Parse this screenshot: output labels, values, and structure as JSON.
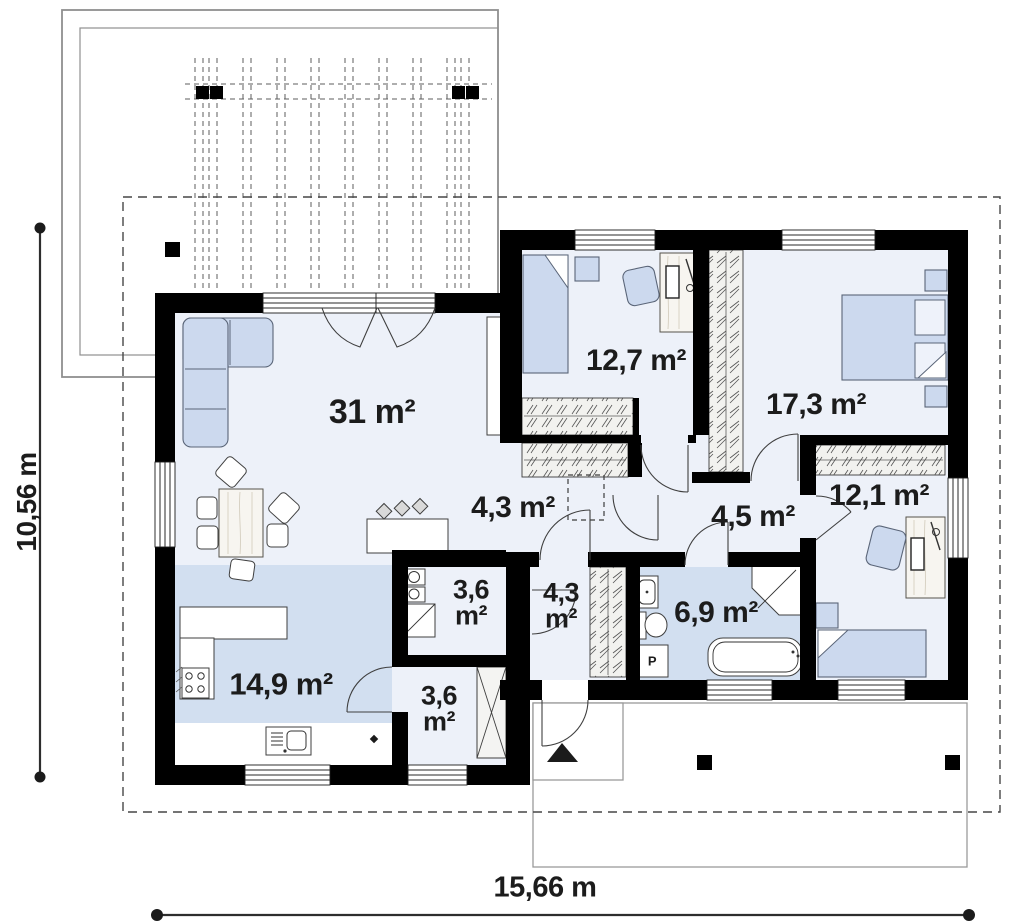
{
  "plan": {
    "rooms": [
      {
        "id": "living-room",
        "area_label": "31 m²"
      },
      {
        "id": "bedroom-1",
        "area_label": "12,7 m²"
      },
      {
        "id": "bedroom-2",
        "area_label": "17,3 m²"
      },
      {
        "id": "hallway",
        "area_label": "4,3 m²"
      },
      {
        "id": "corridor",
        "area_label": "4,5 m²"
      },
      {
        "id": "bedroom-3",
        "area_label": "12,1 m²"
      },
      {
        "id": "pantry",
        "area_label": "3,6 m²"
      },
      {
        "id": "entry-hall",
        "area_label": "4,3 m²"
      },
      {
        "id": "bathroom",
        "area_label": "6,9 m²"
      },
      {
        "id": "kitchen",
        "area_label": "14,9 m²"
      },
      {
        "id": "storage",
        "area_label": "3,6 m²"
      }
    ],
    "dimensions": {
      "width_label": "15,66 m",
      "height_label": "10,56 m"
    },
    "fixtures": {
      "washer_label": "P"
    },
    "palette": {
      "wall": "#000000",
      "room_floor": "#edf1f9",
      "accent_floor": "#d2dff0",
      "furniture_blue": "#ccd9ee",
      "outline": "#3f3f3f"
    }
  }
}
